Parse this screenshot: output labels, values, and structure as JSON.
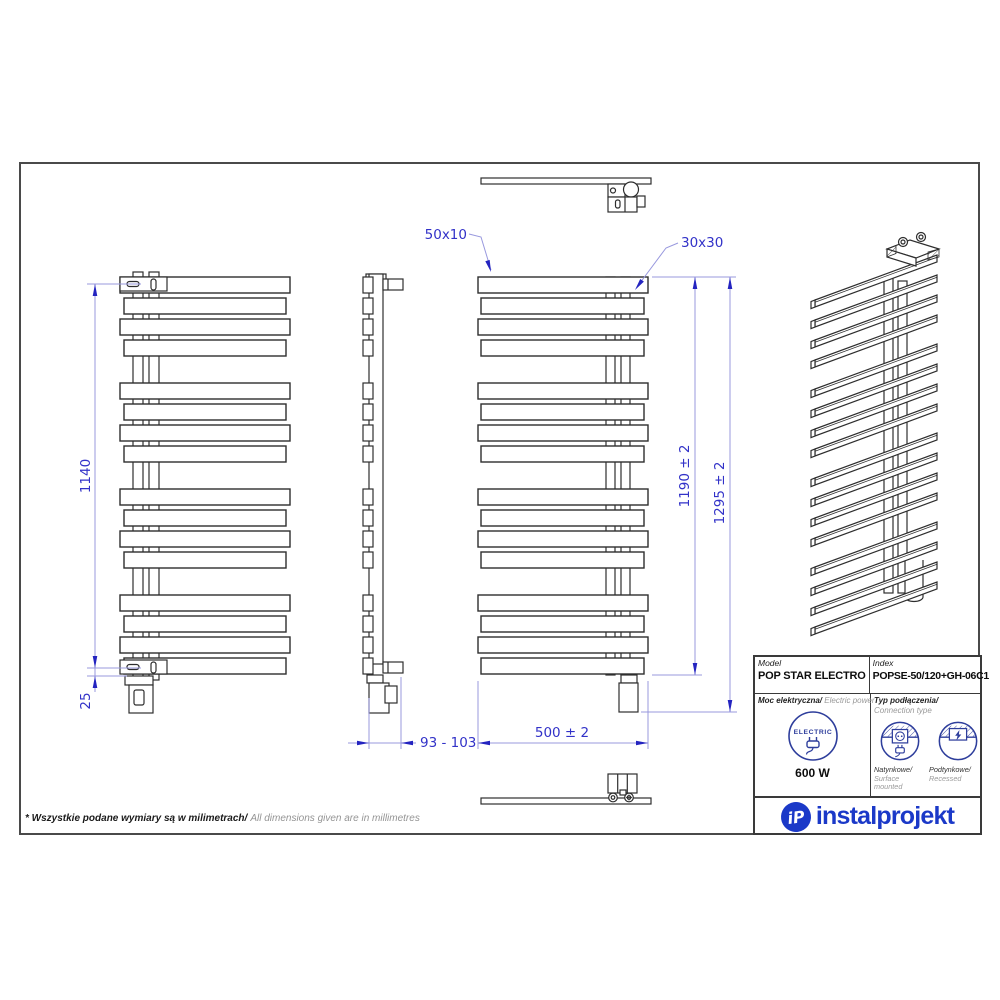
{
  "drawing": {
    "dims": {
      "axis_spacing": "1140",
      "bottom_margin": "25",
      "wall_distance": "93 - 103",
      "bar_profile": "50x10",
      "collector_profile": "30x30",
      "body_height": "1190 ± 2",
      "total_height": "1295 ± 2",
      "width": "500 ± 2"
    },
    "footer": {
      "note_pl": "* Wszystkie podane wymiary są w milimetrach/",
      "note_en": "All dimensions given are in millimetres"
    }
  },
  "title_block": {
    "model_label": "Model",
    "model_value": "POP STAR ELECTRO",
    "index_label": "Index",
    "index_value": "POPSE-50/120+GH-06C1",
    "power_label_pl": "Moc elektryczna/",
    "power_label_en": " Electric power",
    "power_value": "600 W",
    "electric_badge": "ELECTRIC",
    "connection_label_pl": "Typ podłączenia/",
    "connection_label_en": "Connection type",
    "surface_label_pl": "Natynkowe/",
    "surface_label_en": "Surface mounted",
    "recessed_label_pl": "Podtynkowe/",
    "recessed_label_en": "Recessed",
    "logo_text": "instalprojekt",
    "logo_monogram": "iP"
  },
  "colors": {
    "drawing_line": "#2e2e2e",
    "dimension_text": "#3232c8",
    "dimension_line": "#9898de",
    "arrow_blue": "#2424c0",
    "logo_blue": "#1b39c8",
    "icon_navy": "#2e3e9c"
  }
}
